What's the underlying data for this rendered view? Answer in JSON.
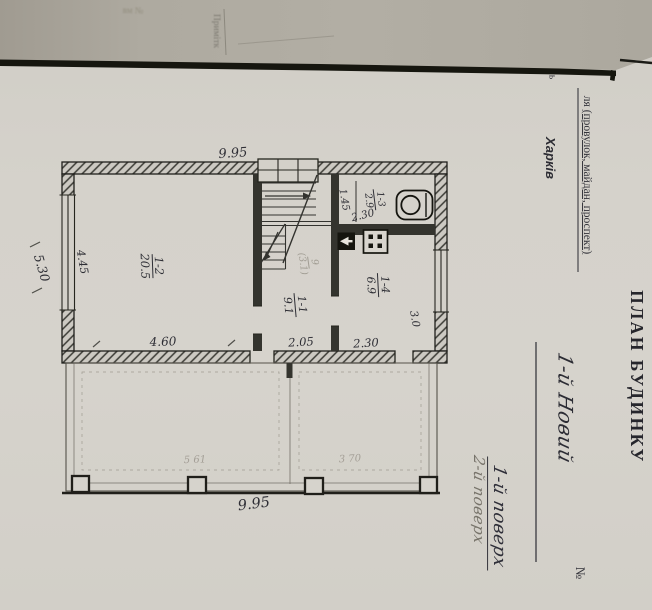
{
  "colors": {
    "paper": "#d5d2cb",
    "scanner_strip": "#aba69c",
    "ink": "#2e2e35",
    "pencil": "#8f8a80",
    "rule_black": "#16160f"
  },
  "scanner_strip": {
    "stamp_faint": "вм №",
    "note_vertical": "Примітк"
  },
  "form": {
    "title": "ПЛАН БУДИНКУ",
    "street_caption_prefix": "ля ",
    "street_caption_underlined": "(провулок, майдан, проспект)",
    "city": "Харків",
    "street_value_handwritten": "1-й Новий",
    "numero_symbol": "№",
    "cut_letter": "ь",
    "floor_numerator": "1-й поверх",
    "floor_denominator": "2-й поверх"
  },
  "plan": {
    "overall": {
      "width_top": "9.95",
      "width_bottom": "9.95",
      "depth_left": "5.30"
    },
    "rooms": [
      {
        "number": "1-1",
        "area": "9.1",
        "width": "2.05"
      },
      {
        "number": "1-2",
        "area": "20.5",
        "width": "4.60",
        "depth": "4.45"
      },
      {
        "number": "1-3",
        "area": "2.9",
        "width": "2.30",
        "depth": "1.45"
      },
      {
        "number": "1-4",
        "area": "6.9",
        "width": "2.30",
        "depth": "3.0"
      }
    ],
    "pencil_marks": {
      "hall_number": "9",
      "hall_area": "(3.1)",
      "veranda_left": "5 61",
      "veranda_right": "3 70"
    }
  }
}
